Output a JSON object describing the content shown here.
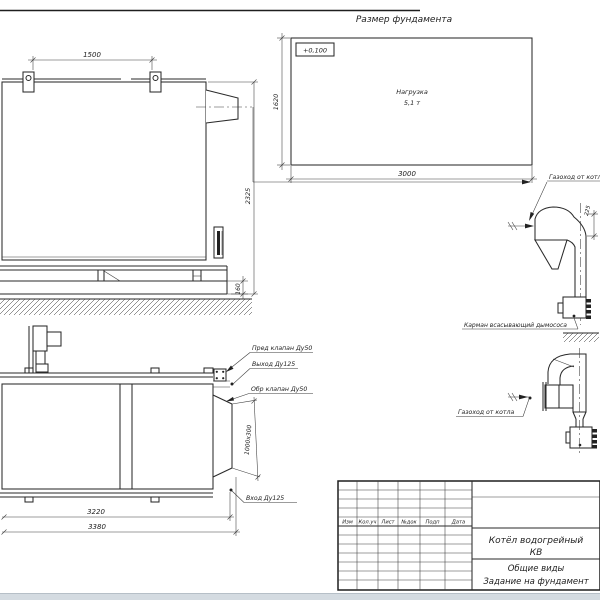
{
  "colors": {
    "ink": "#2a2a2a",
    "background": "#ffffff",
    "page_edge": "#d4dbe1"
  },
  "foundation": {
    "title": "Размер фундамента",
    "level": "+0,100",
    "load1": "Нагрузка",
    "load2": "5,1 т",
    "dim_w": "3000",
    "dim_h": "1620"
  },
  "side": {
    "dim_lug_span": "1500",
    "dim_height": "2325",
    "dim_frame": "160"
  },
  "plan": {
    "callout_safety_valve": "Пред клапан Ду50",
    "callout_outlet": "Выход Ду125",
    "callout_check_valve": "Обр клапан Ду50",
    "callout_inlet": "Вход Ду125",
    "dim_opening": "1000х300",
    "dim_len_inner": "3220",
    "dim_len_outer": "3380"
  },
  "duct_top": {
    "label": "Газоход от котла",
    "pocket_label": "Карман всасывающий дымососа",
    "dim": "225"
  },
  "duct_bottom": {
    "label": "Газоход от котла"
  },
  "title_block": {
    "cols": [
      "Изм",
      "Кол.уч",
      "Лист",
      "№док",
      "Подп",
      "Дата"
    ],
    "name1": "Котёл водогрейный",
    "name2": "КВ",
    "view": "Общие виды",
    "subject": "Задание на фундамент"
  }
}
